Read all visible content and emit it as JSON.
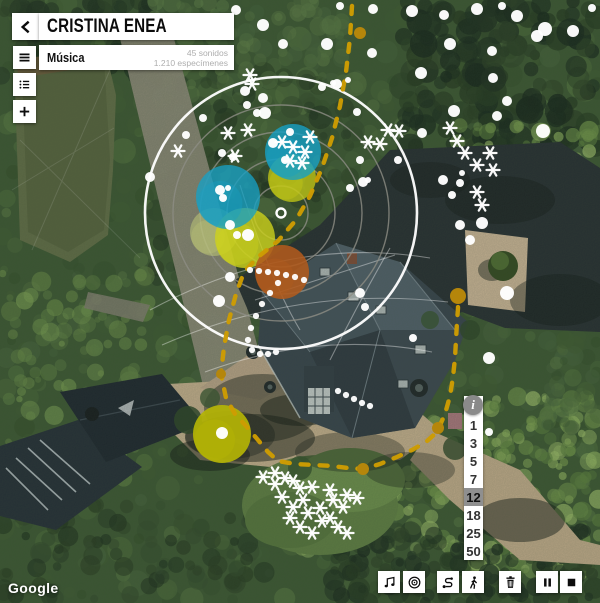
{
  "header": {
    "title": "CRISTINA ENEA",
    "subtitle": "Música",
    "stat_sounds": "45 sonidos",
    "stat_specimens": "1.210 especímenes"
  },
  "sidebar": {
    "buttons": [
      {
        "name": "back"
      },
      {
        "name": "menu"
      },
      {
        "name": "species-list"
      },
      {
        "name": "add"
      }
    ]
  },
  "scale": {
    "info": "i",
    "levels": [
      "1",
      "3",
      "5",
      "7",
      "12",
      "18",
      "25",
      "50"
    ],
    "selected": "12"
  },
  "toolbar": {
    "buttons": [
      {
        "name": "music"
      },
      {
        "name": "target"
      },
      {
        "name": "route"
      },
      {
        "name": "walk"
      },
      {
        "name": "trash"
      },
      {
        "name": "pause"
      },
      {
        "name": "stop"
      }
    ]
  },
  "watermark": "Google",
  "overlay": {
    "colors": {
      "gold": "#cd9c02",
      "gold_node": "#b5860b",
      "blue": "#17a0c4",
      "yellow": "#cdd21c",
      "olive": "#b4b405",
      "orange": "#b05a1d",
      "ring_gray": "#8d8d85",
      "white": "#ffffff"
    },
    "center": {
      "x": 281,
      "y": 213
    },
    "ring_radii": [
      27,
      54,
      81,
      108
    ],
    "outer_radius": 136,
    "blobs": [
      [
        292,
        178,
        24,
        "#c6cb16",
        0.75
      ],
      [
        293,
        152,
        28,
        "#17a0c4",
        0.8
      ],
      [
        214,
        232,
        24,
        "#ccd67a",
        0.45
      ],
      [
        245,
        238,
        30,
        "#cdd21c",
        0.8
      ],
      [
        228,
        197,
        32,
        "#17a0c4",
        0.78
      ],
      [
        282,
        272,
        27,
        "#b05a1d",
        0.88
      ],
      [
        222,
        434,
        29,
        "#b4b405",
        0.92
      ]
    ],
    "route": [
      [
        352,
        6
      ],
      [
        350,
        38
      ],
      [
        346,
        72
      ],
      [
        340,
        106
      ],
      [
        332,
        138
      ],
      [
        322,
        168
      ],
      [
        310,
        196
      ],
      [
        296,
        220
      ],
      [
        278,
        241
      ],
      [
        258,
        257
      ],
      [
        244,
        272
      ],
      [
        236,
        294
      ],
      [
        229,
        320
      ],
      [
        224,
        347
      ],
      [
        221,
        374
      ],
      [
        226,
        398
      ],
      [
        235,
        414
      ],
      [
        247,
        427
      ],
      [
        258,
        440
      ],
      [
        268,
        452
      ],
      [
        278,
        461
      ],
      [
        295,
        464
      ],
      [
        315,
        465
      ],
      [
        332,
        466
      ],
      [
        348,
        468
      ],
      [
        363,
        469
      ],
      [
        380,
        464
      ],
      [
        397,
        457
      ],
      [
        412,
        450
      ],
      [
        426,
        442
      ],
      [
        437,
        432
      ],
      [
        445,
        414
      ],
      [
        450,
        396
      ],
      [
        453,
        377
      ],
      [
        455,
        358
      ],
      [
        456,
        340
      ],
      [
        457,
        322
      ],
      [
        458,
        308
      ],
      [
        458,
        296
      ]
    ],
    "route_nodes": [
      [
        360,
        33,
        6
      ],
      [
        221,
        374,
        5
      ],
      [
        363,
        469,
        6
      ],
      [
        438,
        428,
        6
      ],
      [
        458,
        296,
        8
      ]
    ],
    "dots": [
      [
        236,
        10,
        5
      ],
      [
        263,
        25,
        6
      ],
      [
        340,
        6,
        4
      ],
      [
        373,
        9,
        5
      ],
      [
        412,
        11,
        6
      ],
      [
        444,
        15,
        5
      ],
      [
        477,
        9,
        6
      ],
      [
        502,
        6,
        4
      ],
      [
        517,
        16,
        6
      ],
      [
        545,
        29,
        7
      ],
      [
        573,
        31,
        6
      ],
      [
        592,
        8,
        4
      ],
      [
        283,
        44,
        5
      ],
      [
        327,
        44,
        6
      ],
      [
        372,
        53,
        5
      ],
      [
        450,
        44,
        6
      ],
      [
        492,
        51,
        5
      ],
      [
        537,
        36,
        6
      ],
      [
        421,
        73,
        6
      ],
      [
        493,
        78,
        5
      ],
      [
        337,
        84,
        5
      ],
      [
        348,
        80,
        3
      ],
      [
        245,
        91,
        5
      ],
      [
        263,
        98,
        5
      ],
      [
        322,
        87,
        4
      ],
      [
        333,
        83,
        3
      ],
      [
        265,
        113,
        6
      ],
      [
        273,
        143,
        5
      ],
      [
        454,
        111,
        6
      ],
      [
        497,
        116,
        5
      ],
      [
        507,
        101,
        5
      ],
      [
        422,
        133,
        5
      ],
      [
        543,
        131,
        7
      ],
      [
        257,
        113,
        4
      ],
      [
        247,
        105,
        4
      ],
      [
        222,
        153,
        4
      ],
      [
        233,
        157,
        4
      ],
      [
        220,
        190,
        5
      ],
      [
        228,
        188,
        3
      ],
      [
        223,
        198,
        4
      ],
      [
        230,
        225,
        5
      ],
      [
        248,
        235,
        6
      ],
      [
        237,
        235,
        4
      ],
      [
        290,
        132,
        4
      ],
      [
        285,
        160,
        4
      ],
      [
        357,
        112,
        4
      ],
      [
        360,
        160,
        4
      ],
      [
        363,
        182,
        5
      ],
      [
        368,
        180,
        3
      ],
      [
        350,
        188,
        4
      ],
      [
        443,
        180,
        5
      ],
      [
        460,
        183,
        4
      ],
      [
        462,
        173,
        3
      ],
      [
        452,
        195,
        4
      ],
      [
        398,
        160,
        4
      ],
      [
        460,
        225,
        5
      ],
      [
        230,
        277,
        5
      ],
      [
        360,
        293,
        5
      ],
      [
        365,
        307,
        4
      ],
      [
        482,
        223,
        6
      ],
      [
        470,
        240,
        5
      ],
      [
        219,
        301,
        6
      ],
      [
        413,
        338,
        4
      ],
      [
        507,
        293,
        7
      ],
      [
        489,
        358,
        6
      ],
      [
        489,
        432,
        4
      ],
      [
        150,
        177,
        5
      ],
      [
        222,
        433,
        6
      ],
      [
        186,
        135,
        4
      ],
      [
        203,
        118,
        4
      ]
    ],
    "trail_dots": [
      [
        250,
        270
      ],
      [
        259,
        271
      ],
      [
        268,
        272
      ],
      [
        277,
        273
      ],
      [
        286,
        275
      ],
      [
        295,
        277
      ],
      [
        304,
        280
      ],
      [
        278,
        283
      ],
      [
        270,
        293
      ],
      [
        262,
        304
      ],
      [
        256,
        316
      ],
      [
        251,
        328
      ],
      [
        248,
        340
      ],
      [
        252,
        350
      ],
      [
        260,
        354
      ],
      [
        268,
        354
      ],
      [
        276,
        352
      ],
      [
        338,
        391
      ],
      [
        346,
        395
      ],
      [
        354,
        399
      ],
      [
        362,
        403
      ],
      [
        370,
        406
      ]
    ],
    "asterisks": [
      [
        250,
        75
      ],
      [
        252,
        84
      ],
      [
        228,
        133
      ],
      [
        248,
        130
      ],
      [
        235,
        156
      ],
      [
        178,
        151
      ],
      [
        282,
        142
      ],
      [
        293,
        147
      ],
      [
        305,
        152
      ],
      [
        310,
        137
      ],
      [
        290,
        161
      ],
      [
        302,
        163
      ],
      [
        368,
        142
      ],
      [
        388,
        130
      ],
      [
        399,
        131
      ],
      [
        380,
        144
      ],
      [
        450,
        128
      ],
      [
        457,
        141
      ],
      [
        465,
        153
      ],
      [
        477,
        165
      ],
      [
        490,
        153
      ],
      [
        493,
        170
      ],
      [
        477,
        192
      ],
      [
        482,
        205
      ],
      [
        263,
        477
      ],
      [
        275,
        473
      ],
      [
        285,
        478
      ],
      [
        293,
        481
      ],
      [
        300,
        488
      ],
      [
        312,
        487
      ],
      [
        275,
        484
      ],
      [
        282,
        497
      ],
      [
        293,
        507
      ],
      [
        303,
        500
      ],
      [
        320,
        508
      ],
      [
        330,
        490
      ],
      [
        333,
        500
      ],
      [
        343,
        507
      ],
      [
        347,
        495
      ],
      [
        357,
        498
      ],
      [
        330,
        518
      ],
      [
        338,
        527
      ],
      [
        347,
        533
      ],
      [
        300,
        527
      ],
      [
        290,
        518
      ],
      [
        312,
        533
      ],
      [
        322,
        521
      ],
      [
        308,
        513
      ]
    ]
  }
}
